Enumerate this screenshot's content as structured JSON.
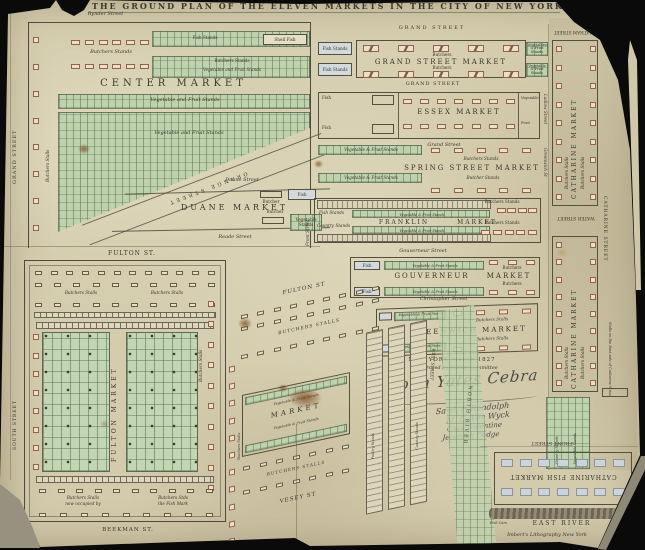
{
  "title": "THE GROUND PLAN OF THE ELEVEN MARKETS IN THE CITY OF NEW YORK 1827.",
  "imprint": "Imbert's Lithography New York",
  "colors": {
    "paper": "#d8d0b4",
    "ink": "#46423a",
    "green": "#bfd2ae",
    "stall_red": "#94604f",
    "fish_blue": "#d3dade",
    "backdrop": "#0a0a0a"
  },
  "centre": {
    "street_top": "Rynder Street",
    "street_left": "GRAND STREET",
    "stalls_left": "Butchers Stalls",
    "stands": "Butchers Stands",
    "fish": "Fish Stands",
    "shell": "Shell Fish",
    "band2a": "Butchers Stands",
    "band2b": "Vegetable and Fruit Stands",
    "name": "CENTER MARKET",
    "veg1": "Vegetable and Fruit Stands",
    "veg2": "Vegetable and Fruit Stands",
    "diag": "ORANGE STREET"
  },
  "duane": {
    "street_top": "Duane Street",
    "name": "DUANE MARKET",
    "street_bottom": "Reade Street",
    "butcher1": "Butcher",
    "fish": "Fish",
    "butcher2": "Butcher",
    "veg": "Vegetable Stands"
  },
  "grand": {
    "street_top": "GRAND STREET",
    "street_bottom": "GRAND STREET",
    "name": "GRAND STREET MARKET",
    "butchers_top": "Butchers",
    "butchers_bottom": "Butchers",
    "fish1": "Fish Stands",
    "fish2": "Fish Stands",
    "veg1": "Vegetables & Fruit Stands",
    "veg2": "Vegetable & Fruit Stands"
  },
  "essex": {
    "name": "ESSEX MARKET",
    "fish1": "Fish",
    "fish2": "Fish",
    "veg": "Vegetable",
    "fruit": "Fruit",
    "street_right": "Ludlow Street",
    "street_bottom": "Grand Street"
  },
  "spring": {
    "name": "SPRING STREET MARKET",
    "butchers1": "Butchers Stands",
    "butchers2": "Butcher Stands",
    "veg1": "Vegetable & Fruit Stands",
    "veg2": "Vegetable & Fruit Stands",
    "street_right": "Greenwich St"
  },
  "franklin": {
    "street_left": "Front Street",
    "name1": "FRANKLIN",
    "name2": "MARKET",
    "fish": "Fish Stands",
    "country": "Country Stands",
    "veg1": "Vegetable & Fruit Stands",
    "veg2": "Vegetable & Fruit Stands",
    "butchers1": "Butchers Stands",
    "butchers2": "Butchers Stands"
  },
  "gouverneur": {
    "street_top": "Gouverneur Street",
    "name1": "GOUVERNEUR",
    "name2": "MARKET",
    "fish1": "Fish",
    "fish2": "Fish",
    "veg1": "Vegetable & Fruit Stands",
    "veg2": "Vegetable & Fruit Stands",
    "butchers1": "Butchers",
    "butchers2": "Butchers"
  },
  "greenwich": {
    "street_top": "Christopher Street",
    "name": "GREENWICH MARKET",
    "stalls1": "Butchers Stalls",
    "stalls2": "Butchers Stalls",
    "veg1": "Vegetable & Fruit Stands",
    "veg2": "Vegetable & Fruit Stands",
    "fish1": "Fish",
    "fish2": "Fish"
  },
  "approval": {
    "line1": "NEW YORK   March 1827",
    "line2": "Approved by Market Committee"
  },
  "signatures": [
    "John Yates Cebra",
    "Saml. F. Randolph",
    "M. G. Van Wyck",
    "Chas. Valentine",
    "Jeremiah Dodge"
  ],
  "catharine": {
    "street_top": "CHATHAM STREET",
    "market1": "CATHARINE MARKET",
    "m1_stalls1": "Butchers Stalls",
    "m1_stalls2": "Butchers Stalls",
    "water": "WATER STREET",
    "street_right": "CATHARINE STREET",
    "market2": "CATHARINE MARKET",
    "m2_stalls1": "Butchers Stalls",
    "m2_stalls2": "Butchers Stalls",
    "green1": "Country Stands",
    "green2": "Vegetable Stands",
    "note": "Stalls on the East side of Catharine Street"
  },
  "fulton": {
    "street_top": "FULTON ST.",
    "stalls1": "Butchers Stalls",
    "stalls2": "Butchers Stalls",
    "street_left": "SOUTH STREET",
    "name": "FULTON MARKET",
    "stalls_right": "Butchers Stalls",
    "note1a": "Butchers Stalls",
    "note1b": "now occupied by",
    "note2a": "Butchers Stds",
    "note2b": "the Fish Mark",
    "street_bottom": "BEEKMAN ST."
  },
  "washington": {
    "street_top": "FULTON ST",
    "stalls_diag1": "BUTCHERS STALLS",
    "stalls_left": "Butchers Stalls",
    "veg1": "Vegetable & Fruit Stands",
    "name": "MARKET",
    "veg2": "Vegetable & Fruit Stands",
    "col1": "Poultry Stands",
    "col2": "Country Stands",
    "stalls_diag2": "BUTCHERS STALLS",
    "street_bottom": "VESEY ST",
    "west": "WEST STREET",
    "river": "NORTH RIVER"
  },
  "catharine_fish": {
    "street_top": "FRONT STREET",
    "name": "CATHARINE FISH MARKET",
    "cars1": "Fish Cars",
    "cars2": "Fish Cars",
    "river": "EAST RIVER"
  }
}
